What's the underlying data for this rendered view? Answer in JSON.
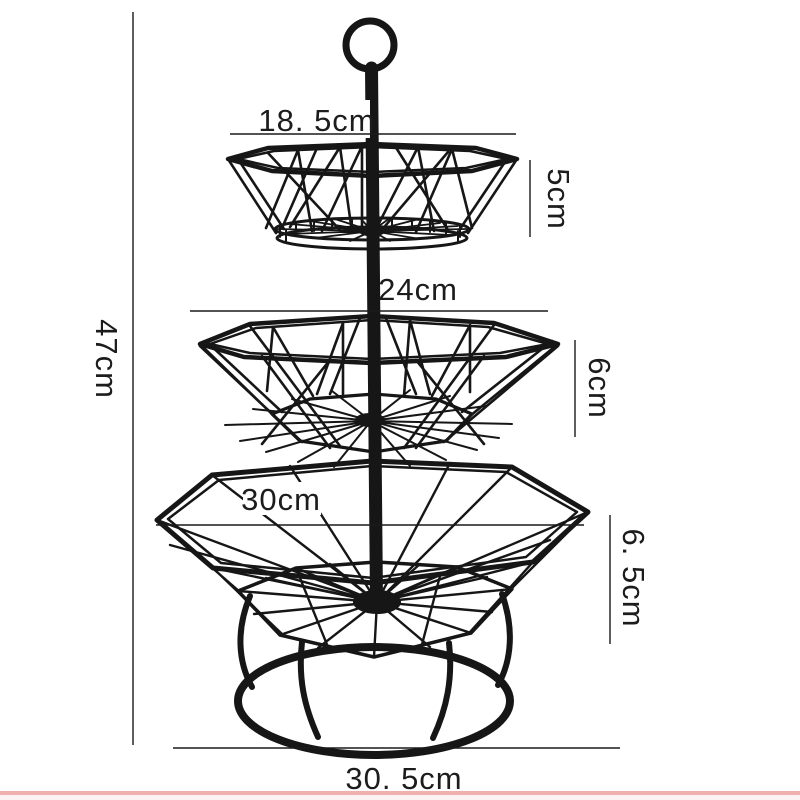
{
  "labels": {
    "top_width": "18. 5cm",
    "top_height": "5cm",
    "mid_width": "24cm",
    "mid_height": "6cm",
    "bottom_width": "30cm",
    "bottom_height": "6. 5cm",
    "total_height": "47cm",
    "base_width": "30. 5cm"
  },
  "colors": {
    "background": "#ffffff",
    "wire": "#161616",
    "dimension_line": "#1a1a1a",
    "label_text": "#1c1c1c",
    "bottom_stripe": "#efb0ae",
    "bottom_stripe_faint": "#fbf3f3"
  }
}
